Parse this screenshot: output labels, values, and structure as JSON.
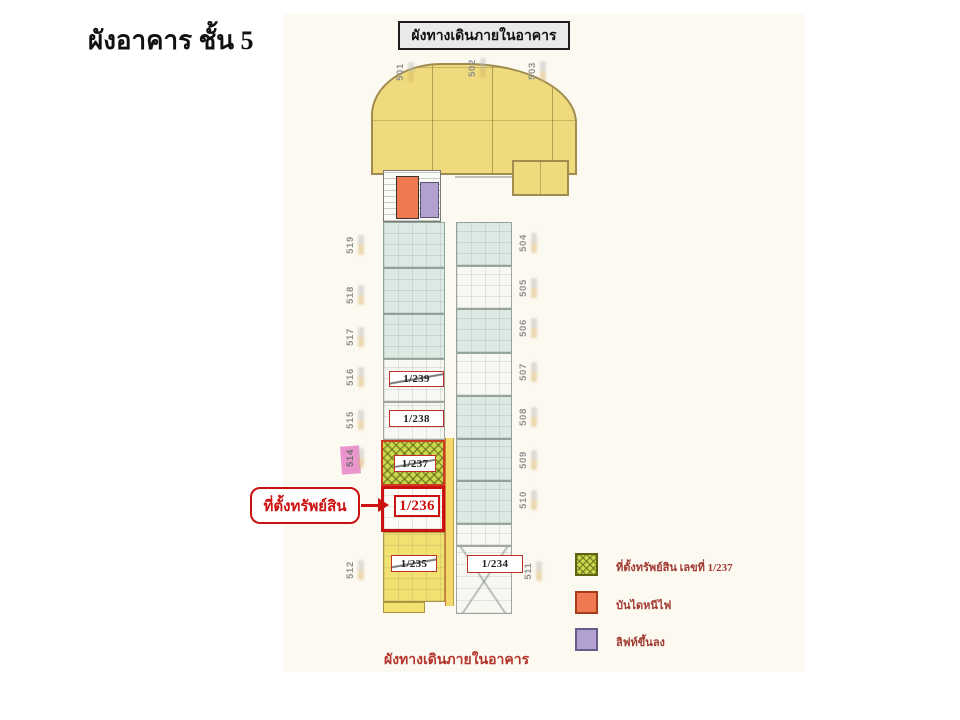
{
  "page": {
    "title": "ผังอาคาร ชั้น 5",
    "corridor_box_label": "ผังทางเดินภายในอาคาร",
    "bottom_caption": "ผังทางเดินภายในอาคาร"
  },
  "callout": {
    "label": "ที่ตั้งทรัพย์สิน"
  },
  "plan": {
    "top_labels": [
      "501",
      "502",
      "503"
    ],
    "left_labels": [
      "519",
      "518",
      "517",
      "516",
      "515",
      "514",
      "512"
    ],
    "right_labels": [
      "504",
      "505",
      "506",
      "507",
      "508",
      "509",
      "510",
      "511"
    ],
    "units": [
      {
        "label": "1/239"
      },
      {
        "label": "1/238"
      },
      {
        "label": "1/237"
      },
      {
        "label": "1/236"
      },
      {
        "label": "1/235"
      },
      {
        "label": "1/234"
      }
    ],
    "highlighted_unit": "1/236",
    "highlighted_side_label": "514"
  },
  "legend": {
    "items": [
      {
        "label": "ที่ตั้งทรัพย์สิน เลขที่ 1/237",
        "swatch_color": "#ccd84e",
        "swatch_style": "hatched"
      },
      {
        "label": "บันไดหนีไฟ",
        "swatch_color": "#ef7a52",
        "swatch_style": "solid"
      },
      {
        "label": "ลิฟท์ขึ้นลง",
        "swatch_color": "#b2a0d0",
        "swatch_style": "solid"
      }
    ]
  },
  "colors": {
    "highlight_red": "#cc1111",
    "arch_yellow": "#efdb7d",
    "room_teal": "#dde9e3",
    "room_yellow": "#f2e170",
    "hatch_green": "#ccd84e",
    "fire_escape_orange": "#ef7a52",
    "elevator_purple": "#b2a0d0",
    "legend_text": "#a03a32",
    "side_label_gray": "#8f8f8f",
    "pink_highlight": "#e884c8"
  }
}
